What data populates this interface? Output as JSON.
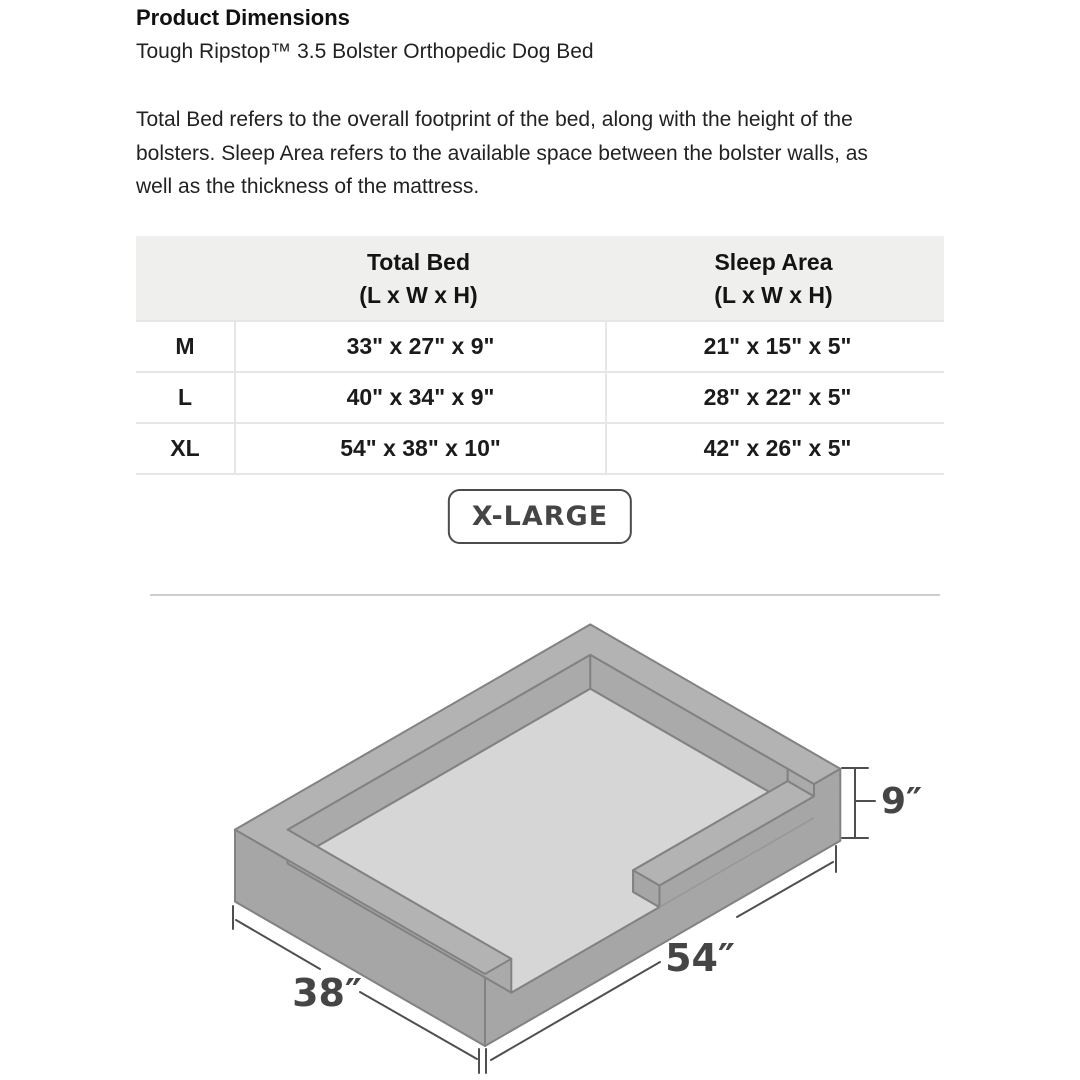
{
  "page": {
    "title": "Product Dimensions",
    "subtitle": "Tough Ripstop™ 3.5 Bolster Orthopedic Dog Bed",
    "description": "Total Bed refers to the overall footprint of the bed, along with the height of the\nbolsters. Sleep Area refers to the available space between the bolster walls, as\nwell as the thickness of the mattress."
  },
  "table": {
    "header": {
      "size_col": "",
      "total_bed_title": "Total Bed",
      "total_bed_sub": "(L x W x H)",
      "sleep_area_title": "Sleep Area",
      "sleep_area_sub": "(L x W x H)"
    },
    "rows": [
      {
        "size": "M",
        "total_bed": "33\" x 27\" x 9\"",
        "sleep_area": "21\" x 15\" x 5\""
      },
      {
        "size": "L",
        "total_bed": "40\" x 34\" x 9\"",
        "sleep_area": "28\" x 22\" x 5\""
      },
      {
        "size": "XL",
        "total_bed": "54\" x 38\" x 10\"",
        "sleep_area": "42\" x 26\" x 5\""
      }
    ]
  },
  "selected_size": {
    "label": "X-LARGE"
  },
  "diagram": {
    "height_label": "9″",
    "length_label": "54″",
    "width_label": "38″",
    "colors": {
      "top": "#b3b3b3",
      "side": "#a6a6a6",
      "inner": "#aaaaaa",
      "mattress": "#d6d6d6",
      "outline": "#828282",
      "dimension": "#4f4f4f"
    }
  }
}
